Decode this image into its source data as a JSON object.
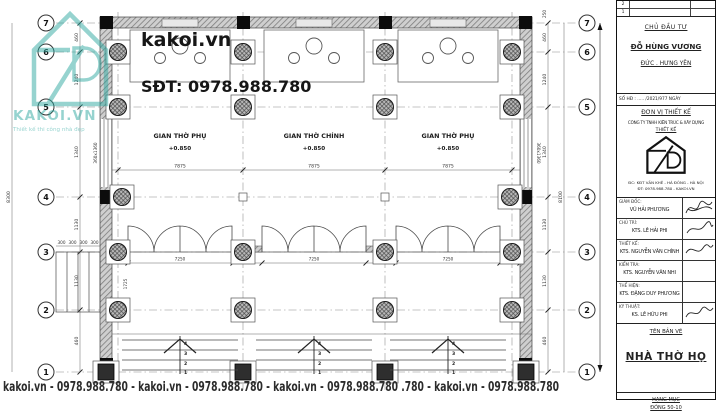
{
  "watermark": {
    "brand": "kakoi.vn",
    "phone": "SĐT: 0978.988.780",
    "logo_text": "KAKOI.VN",
    "logo_tagline": "Thiết kế thi công nhà đẹp",
    "bottom_line": "kakoi.vn - 0978.988.780 - kakoi.vn - 0978.988.780 - kakoi.vn - 0978.988.780 .780 - kakoi.vn - 0978.988.780"
  },
  "plan": {
    "grid_rows": [
      "7",
      "6",
      "5",
      "4",
      "3",
      "2",
      "1"
    ],
    "rooms": [
      {
        "name": "GIAN THỜ PHỤ",
        "level": "+0.850"
      },
      {
        "name": "GIAN THỜ CHÍNH",
        "level": "+0.850"
      },
      {
        "name": "GIAN THỜ PHỤ",
        "level": "+0.850"
      }
    ],
    "step_numbers": [
      "4",
      "3",
      "2",
      "1"
    ],
    "window_tag": "360x1360"
  },
  "dims": {
    "left_total": "8300",
    "right_total": "8100",
    "top_right": "250",
    "row_gaps": [
      "460",
      "1240",
      "1340",
      "1130",
      "1130",
      "460"
    ],
    "bay_width": "7875",
    "door_row": [
      "366",
      "7250",
      "360",
      "7250",
      "360",
      "7250",
      "366"
    ],
    "side_steps": [
      "300",
      "300",
      "300",
      "300"
    ],
    "veranda": "1725"
  },
  "titleblock": {
    "revisions": [
      "2",
      "1"
    ],
    "client_label": "CHỦ ĐẦU TƯ",
    "client_name": "ĐỖ HÙNG VƯƠNG",
    "client_address": "ĐỨC . HƯNG YÊN",
    "contract_line": "SỐ HĐ : ..... /2021/977 NGÀY",
    "unit_label": "ĐƠN VỊ THIẾT KẾ",
    "company_line1": "CÔNG TY TNHH KIẾN TRÚC & XÂY DỰNG",
    "company_line2": "THIẾT KẾ",
    "address_line1": "ĐC: KĐT VĂN KHÊ - HÀ ĐÔNG - HÀ NỘI",
    "address_line2": "ĐT: 0978.988.780 - KAKOI.VN",
    "staff": [
      {
        "role": "GIÁM ĐỐC:",
        "name": "VŨ HẢI PHƯƠNG"
      },
      {
        "role": "CHỦ TRÌ:",
        "name": "KTS. LÊ HẢI PHI"
      },
      {
        "role": "THIẾT KẾ:",
        "name": "KTS. NGUYỄN VĂN CHÍNH"
      },
      {
        "role": "KIỂM TRA:",
        "name": "KTS. NGUYỄN VĂN NHI"
      },
      {
        "role": "THỂ HIỆN:",
        "name": "KTS. ĐẶNG DUY PHƯƠNG"
      },
      {
        "role": "KỸ THUẬT:",
        "name": "KS. LÊ HỮU PHI"
      }
    ],
    "sheet_label": "TÊN BẢN VẼ",
    "sheet_name": "NHÀ THỜ HỌ",
    "item_label": "HẠNG MỤC",
    "item_value": "ĐÓNG 50-10"
  },
  "colors": {
    "teal": "#2fa8a0",
    "line": "#444444"
  }
}
